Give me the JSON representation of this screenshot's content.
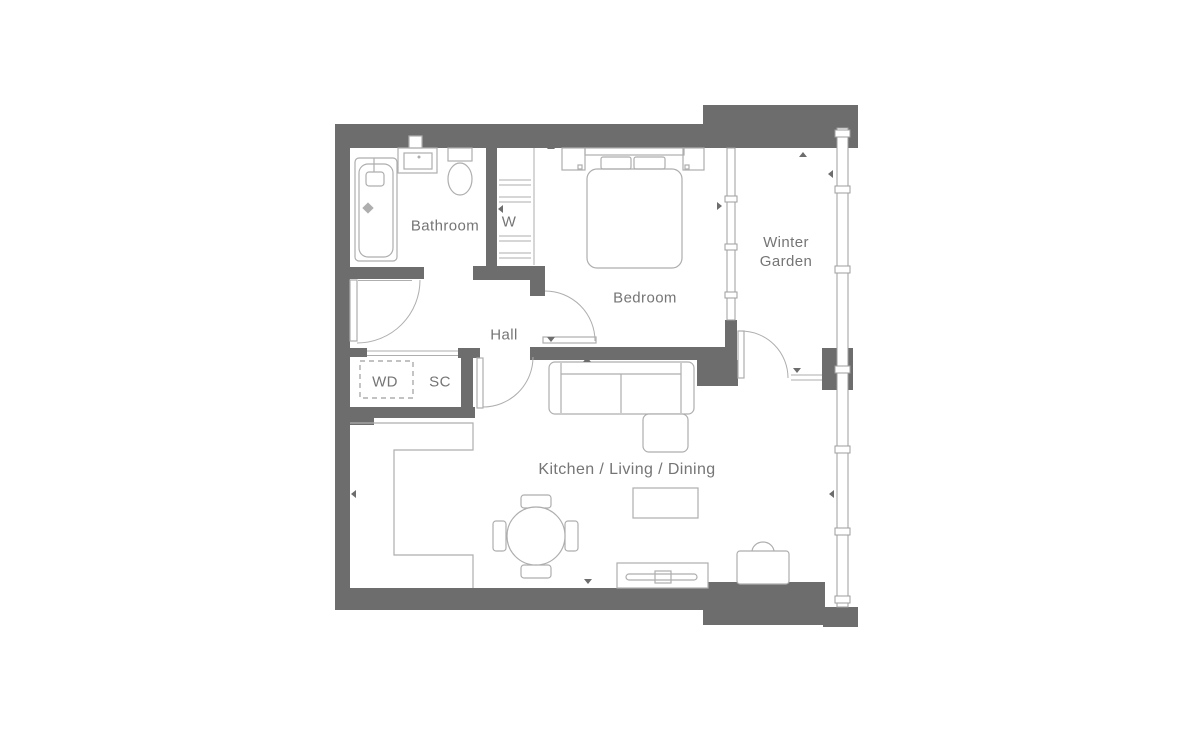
{
  "title": "Apartment floor plan",
  "colors": {
    "wall": "#6d6d6d",
    "furniture_line": "#aeaeae",
    "glazing_line": "#9e9e9e",
    "text": "#757575"
  },
  "rooms": {
    "bathroom": {
      "label": "Bathroom"
    },
    "wardrobe": {
      "label": "W"
    },
    "hall": {
      "label": "Hall"
    },
    "bedroom": {
      "label": "Bedroom"
    },
    "winter_garden": {
      "label": "Winter Garden"
    },
    "washer_dryer": {
      "label": "WD"
    },
    "storage_cupboard": {
      "label": "SC"
    },
    "kitchen_living_dining": {
      "label": "Kitchen / Living / Dining"
    }
  },
  "fixtures": [
    "bathtub",
    "basin-vanity",
    "toilet",
    "wardrobe-shelves",
    "sliding-wardrobe-front",
    "double-bed",
    "nightstand",
    "glazed-partition",
    "full-height-glazing",
    "corner-sofa",
    "coffee-table",
    "tv-unit",
    "armchair",
    "dining-table",
    "dining-chair",
    "kitchen-counter",
    "washer-dryer-bay"
  ]
}
